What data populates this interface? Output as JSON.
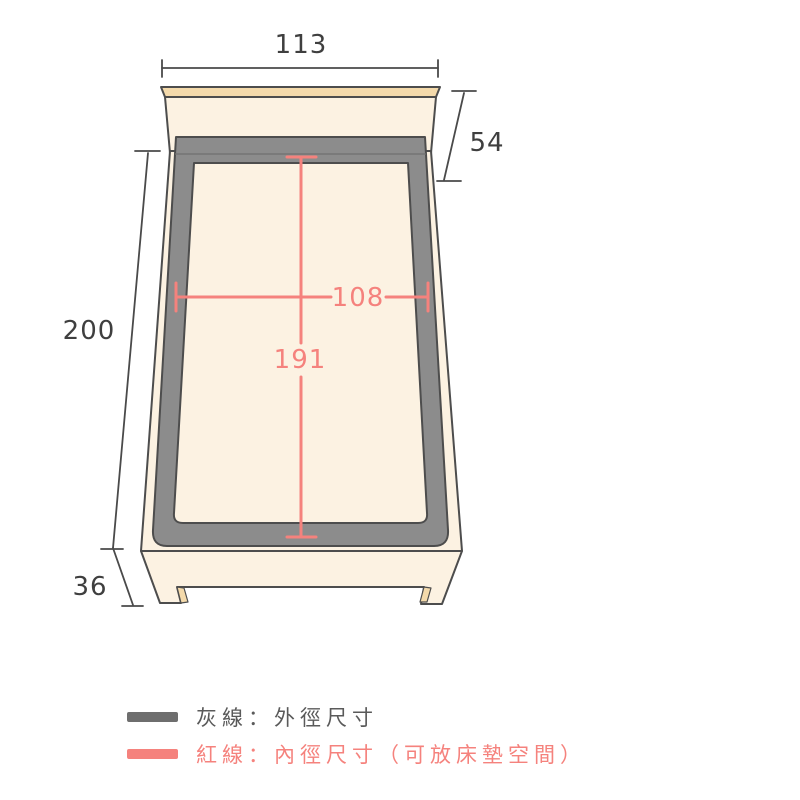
{
  "dimensions": {
    "outer_width": "113",
    "headboard_height": "54",
    "outer_length": "200",
    "footboard_height": "36",
    "inner_width": "108",
    "inner_length": "191"
  },
  "legend": {
    "items": [
      {
        "label": "灰線：外徑尺寸",
        "swatch_color": "#6E6E6E",
        "text_color": "#5A5A5A"
      },
      {
        "label": "紅線：內徑尺寸（可放床墊空間）",
        "swatch_color": "#F5827D",
        "text_color": "#F5827D"
      }
    ]
  },
  "colors": {
    "background": "#FFFFFF",
    "outline": "#4D4D4D",
    "dimension_line": "#4A4A4A",
    "dimension_text": "#3F3F3F",
    "inner_dimension_red": "#F5827D",
    "frame_gray": "#8C8C8C",
    "wood_cream": "#FCF2E2",
    "wood_trim_tan": "#F4DAAB"
  }
}
